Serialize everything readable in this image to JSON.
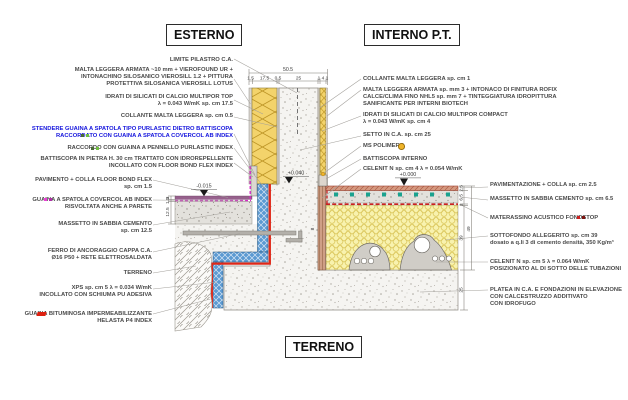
{
  "titles": {
    "exterior": "ESTERNO",
    "interior": "INTERNO P.T.",
    "ground": "TERRENO"
  },
  "labels": {
    "limite_pilastro": {
      "lines": [
        "LIMITE PILASTRO C.A."
      ]
    },
    "malta_esterna": {
      "lines": [
        "MALTA LEGGERA ARMATA ~10 mm +  VIEROFOUND UR +",
        "INTONACHINO SILOSANICO VIEROSILL 1.2 + PITTURA",
        "PROTETTIVA SILOSANICA VIEROSILL LOTUS"
      ]
    },
    "idrati_top": {
      "lines": [
        "IDRATI DI SILICATI DI CALCIO MULTIPOR TOP",
        "λ = 0.043 W/mK  sp. cm 17.5"
      ]
    },
    "collante_est": {
      "lines": [
        "COLLANTE MALTA LEGGERA sp. cm 0.5"
      ]
    },
    "stendere_guaina": {
      "lines": [
        "STENDERE GUAINA A SPATOLA TIPO PURLASTIC DIETRO BATTISCOPA",
        "RACCORDATO CON GUAINA A SPATOLA COVERCOL AB INDEX"
      ]
    },
    "raccordo_pennello": {
      "lines": [
        "RACCORDO CON GUAINA A PENNELLO PURLASTIC INDEX"
      ]
    },
    "battiscopa_pietra": {
      "lines": [
        "BATTISCOPA IN PIETRA H. 30 cm TRATTATO CON IDROREPELLENTE",
        "INCOLLATO CON FLOOR BOND FLEX INDEX"
      ]
    },
    "pavimento_est": {
      "lines": [
        "PAVIMENTO + COLLA FLOOR BOND FLEX",
        "sp. cm 1.5"
      ]
    },
    "guaina_covercol": {
      "lines": [
        "GUAINA A SPATOLA COVERCOL AB INDEX",
        "RISVOLTATA ANCHE A PARETE"
      ]
    },
    "massetto_est": {
      "lines": [
        "MASSETTO IN SABBIA CEMENTO",
        "sp. cm 12.5"
      ]
    },
    "ferro_ancoraggio": {
      "lines": [
        "FERRO DI ANCORAGGIO CAPPA C.A.",
        "Ø16 P50 + RETE ELETTROSALDATA"
      ]
    },
    "terreno": {
      "lines": [
        "TERRENO"
      ]
    },
    "xps": {
      "lines": [
        "XPS sp. cm 5 λ = 0.034 W/mK",
        "INCOLLATO CON SCHIUMA PU ADESIVA"
      ]
    },
    "guaina_bituminosa": {
      "lines": [
        "GUAINA BITUMINOSA IMPERMEABILIZZANTE",
        "HELASTA P4 INDEX"
      ]
    },
    "collante_int": {
      "lines": [
        "COLLANTE MALTA LEGGERA sp. cm 1"
      ]
    },
    "malta_interna": {
      "lines": [
        "MALTA LEGGERA ARMATA sp. mm 3 + INTONACO DI FINITURA ROFIX",
        "CALCE/CLIMA FINO NHL5 sp. mm 7 + TINTEGGIATURA IDROPITTURA",
        "SANIFICANTE PER INTERNI BIOTECH"
      ]
    },
    "idrati_compact": {
      "lines": [
        "IDRATI DI SILICATI DI CALCIO MULTIPOR COMPACT",
        "λ = 0.043 W/mK sp. cm 4"
      ]
    },
    "setto": {
      "lines": [
        "SETTO IN C.A. sp. cm 25"
      ]
    },
    "ms_polimero": {
      "lines": [
        "MS POLIMERO"
      ]
    },
    "battiscopa_int": {
      "lines": [
        "BATTISCOPA INTERNO"
      ]
    },
    "celenit_4": {
      "lines": [
        "CELENIT N sp. cm 4 λ = 0.054 W/mK"
      ]
    },
    "pavimentazione": {
      "lines": [
        "PAVIMENTAZIONE + COLLA sp. cm 2.5"
      ]
    },
    "massetto_int": {
      "lines": [
        "MASSETTO IN SABBIA CEMENTO sp. cm 6.5"
      ]
    },
    "materassino": {
      "lines": [
        "MATERASSINO ACUSTICO FONOSTOP"
      ]
    },
    "sottofondo": {
      "lines": [
        "SOTTOFONDO ALLEGERITO sp. cm 39",
        "dosato a q.li 3 di cemento densità, 350 Kg/m³"
      ]
    },
    "celenit_5": {
      "lines": [
        "CELENIT N sp. cm 5 λ = 0.064 W/mK",
        "POSIZIONATO AL DI SOTTO DELLE TUBAZIONI"
      ]
    },
    "platea": {
      "lines": [
        "PLATEA IN C.A. E FONDAZIONI IN ELEVAZIONE",
        "CON CALCESTRUZZO ADDITIVATO",
        "CON IDROFUGO"
      ]
    }
  },
  "levels": {
    "ext_pavement": "-0.015",
    "wall_base": "+0.040",
    "int_floor": "+0.000"
  },
  "dims": {
    "top_total": "50.5",
    "top_parts": [
      "1.5",
      "17.5",
      "0.5",
      "25",
      "1 4 1"
    ],
    "left": [
      "3",
      "1.5",
      "12.5"
    ],
    "right_inner": [
      "2.5",
      "6.5",
      "1",
      "39",
      "25"
    ],
    "right_outer": "49",
    "wall_base": "8"
  },
  "colors": {
    "insulation_yellow": "#f3d36b",
    "xps_blue": "#5b9ad2",
    "guaina_red": "#e02818",
    "guaina_magenta": "#d826c6",
    "fonostop_red": "#cc2020",
    "sottofondo_yellow": "#f8f2ae",
    "celenit_brown": "#cf9f86",
    "pavimento_viola": "#96618c",
    "pavimentazione_salmone": "#d4987f",
    "label_blue": "#1515dd",
    "marker_yellow": "#f0b429",
    "pipe_teal": "#1ba28f"
  }
}
